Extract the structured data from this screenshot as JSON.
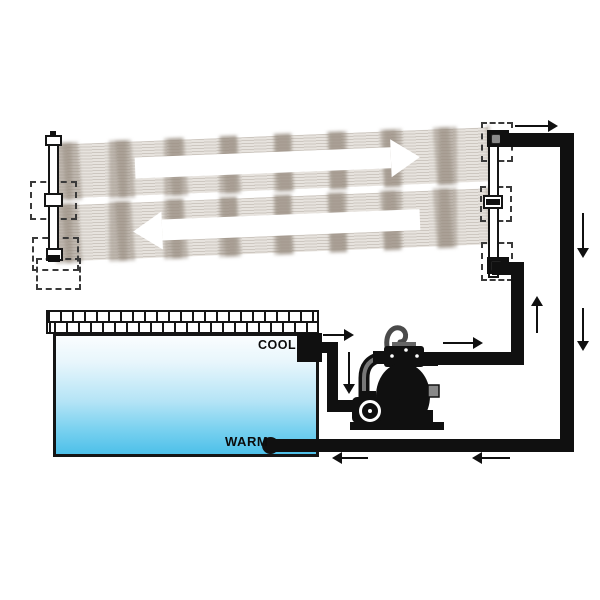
{
  "pool": {
    "cool_label": "COOL",
    "warm_label": "WARM"
  },
  "icons": {
    "flow_arrow_right": "→",
    "flow_arrow_left": "←",
    "flow_arrow_up": "↑",
    "flow_arrow_down": "↓"
  },
  "colors": {
    "background": "#ffffff",
    "pipe": "#101010",
    "panel_line_dark": "#cdc7c0",
    "panel_line_light": "#e7e3de",
    "panel_patch": "rgba(150,139,127,0.5)",
    "pool_top": "#fafdfe",
    "pool_mid": "#b5e4f6",
    "pool_bottom": "#4dc0e9",
    "label_text": "#0b0b0b"
  }
}
